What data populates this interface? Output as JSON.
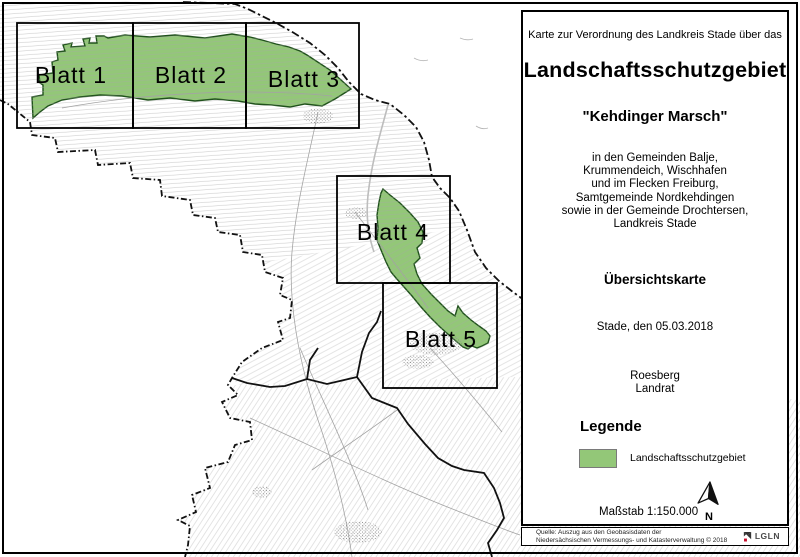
{
  "map": {
    "sheet_labels": [
      "Blatt 1",
      "Blatt 2",
      "Blatt 3",
      "Blatt 4",
      "Blatt 5"
    ]
  },
  "panel": {
    "intro": "Karte zur Verordnung des Landkreis Stade über das",
    "title": "Landschaftsschutzgebiet",
    "subtitle": "\"Kehdinger Marsch\"",
    "municipalities": [
      "in den Gemeinden Balje,",
      "Krummendeich, Wischhafen",
      "und im Flecken Freiburg,",
      "Samtgemeinde Nordkehdingen",
      "sowie in der Gemeinde Drochtersen,",
      "Landkreis Stade"
    ],
    "map_type": "Übersichtskarte",
    "date_line": "Stade, den 05.03.2018",
    "signature_name": "Roesberg",
    "signature_title": "Landrat",
    "legend": {
      "heading": "Legende",
      "item_label": "Landschaftsschutzgebiet",
      "swatch_color": "#93c778"
    },
    "scale_label": "Maßstab 1:150.000",
    "north_label": "N"
  },
  "source": {
    "line1": "Quelle:  Auszug aus den Geobasisdaten der",
    "line2": "Niedersächsischen Vermessungs- und Katasterverwaltung  © 2018",
    "logo_text": "LGLN"
  },
  "colors": {
    "protected_area_fill": "#93c778",
    "protected_area_stroke": "#20511c",
    "map_texture": "#a8a8a8",
    "boundary": "#111111"
  }
}
